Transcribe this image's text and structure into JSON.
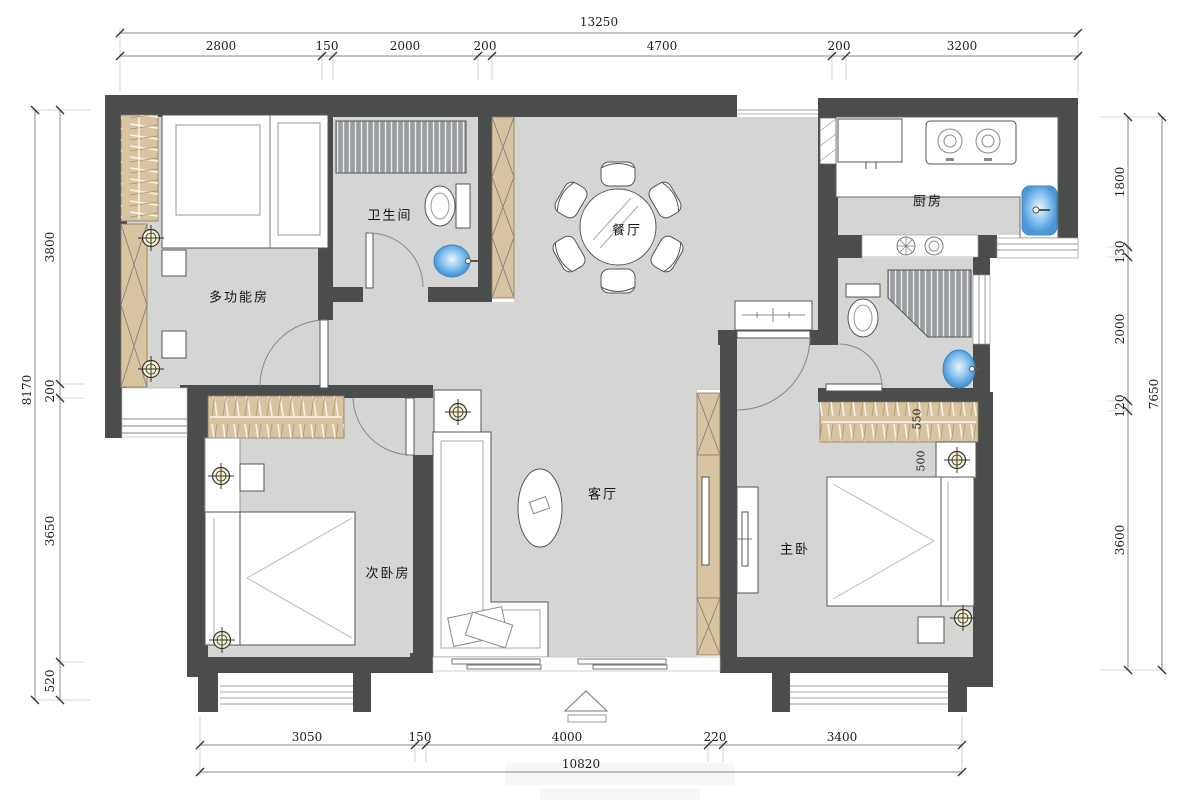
{
  "plan": {
    "rooms": {
      "multi": "多功能房",
      "bath1": "卫生间",
      "dining": "餐厅",
      "kitchen": "厨房",
      "bedroom2": "次卧房",
      "living": "客厅",
      "master": "主卧"
    },
    "inner_dims": {
      "wardrobe_depth": "550",
      "gap": "500"
    },
    "dims": {
      "top": {
        "total": "13250",
        "segments": [
          "2800",
          "150",
          "2000",
          "200",
          "4700",
          "200",
          "3200"
        ]
      },
      "left": {
        "total": "8170",
        "segments": [
          "3800",
          "200",
          "3650",
          "520"
        ]
      },
      "right": {
        "total": "7650",
        "segments": [
          "1800",
          "130",
          "2000",
          "120",
          "3600"
        ]
      },
      "bottom": {
        "total": "10820",
        "segments": [
          "3050",
          "150",
          "4000",
          "220",
          "3400"
        ]
      }
    },
    "colors": {
      "wall": "#4b4d4c",
      "floor": "#d5d6d4",
      "wood": "#d8c4a0",
      "fixture_blue": "#4a97d8",
      "symbol_bg": "#f8f2cf"
    }
  }
}
